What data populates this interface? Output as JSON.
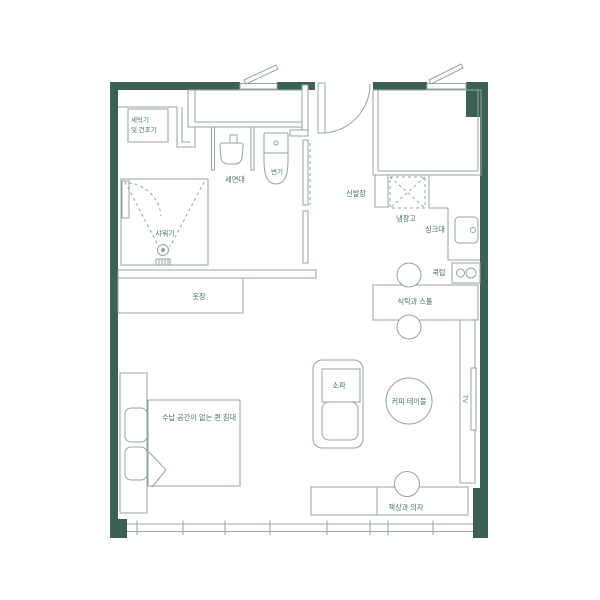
{
  "colors": {
    "wall": "#3c6153",
    "line": "#95a59d",
    "label": "#4a7265",
    "background": "#ffffff"
  },
  "rooms": {
    "laundry": {
      "washer_line1": "세탁기",
      "washer_line2": "및 건조기"
    },
    "bathroom": {
      "basin": "세면대",
      "toilet": "변기",
      "shower": "샤워기"
    },
    "entry": {
      "shoe_cabinet": "신발장"
    },
    "kitchen": {
      "fridge": "냉장고",
      "sink": "싱크대",
      "cooktop": "쿡탑",
      "dining": "식탁과 스툴"
    },
    "living": {
      "sofa": "소파",
      "coffee_table": "커피 테이블",
      "tv": "TV",
      "desk": "책상과 의자"
    },
    "bedroom": {
      "wardrobe": "옷장",
      "bed": "수납 공간이 없는 퀸 침대"
    }
  }
}
